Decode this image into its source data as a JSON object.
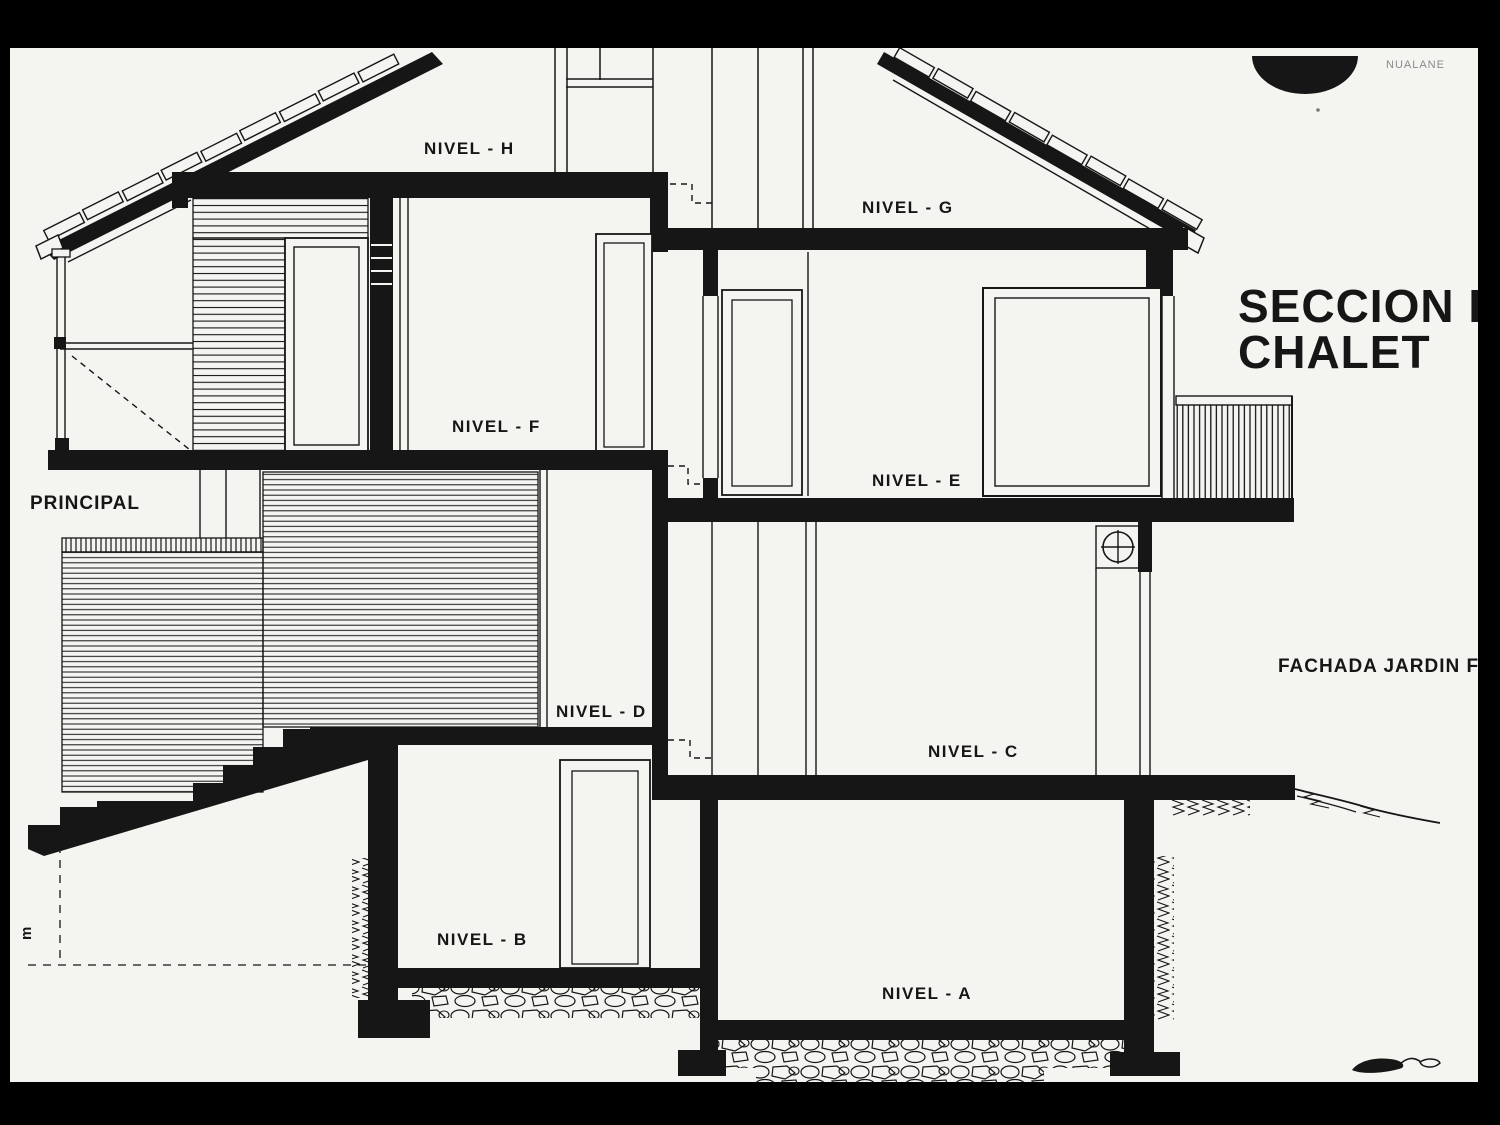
{
  "drawing": {
    "title_line1": "SECCION D",
    "title_line2": "CHALET",
    "corner_note": "NUALANE",
    "facade_label": "FACHADA JARDIN F",
    "principal_label": "PRINCIPAL",
    "dimension_label": "m",
    "levels": {
      "h": "NIVEL - H",
      "g": "NIVEL - G",
      "f": "NIVEL - F",
      "e": "NIVEL - E",
      "d": "NIVEL - D",
      "c": "NIVEL - C",
      "b": "NIVEL - B",
      "a": "NIVEL - A"
    },
    "colors": {
      "ink": "#161616",
      "paper": "#f4f4f1",
      "border": "#000000"
    }
  }
}
